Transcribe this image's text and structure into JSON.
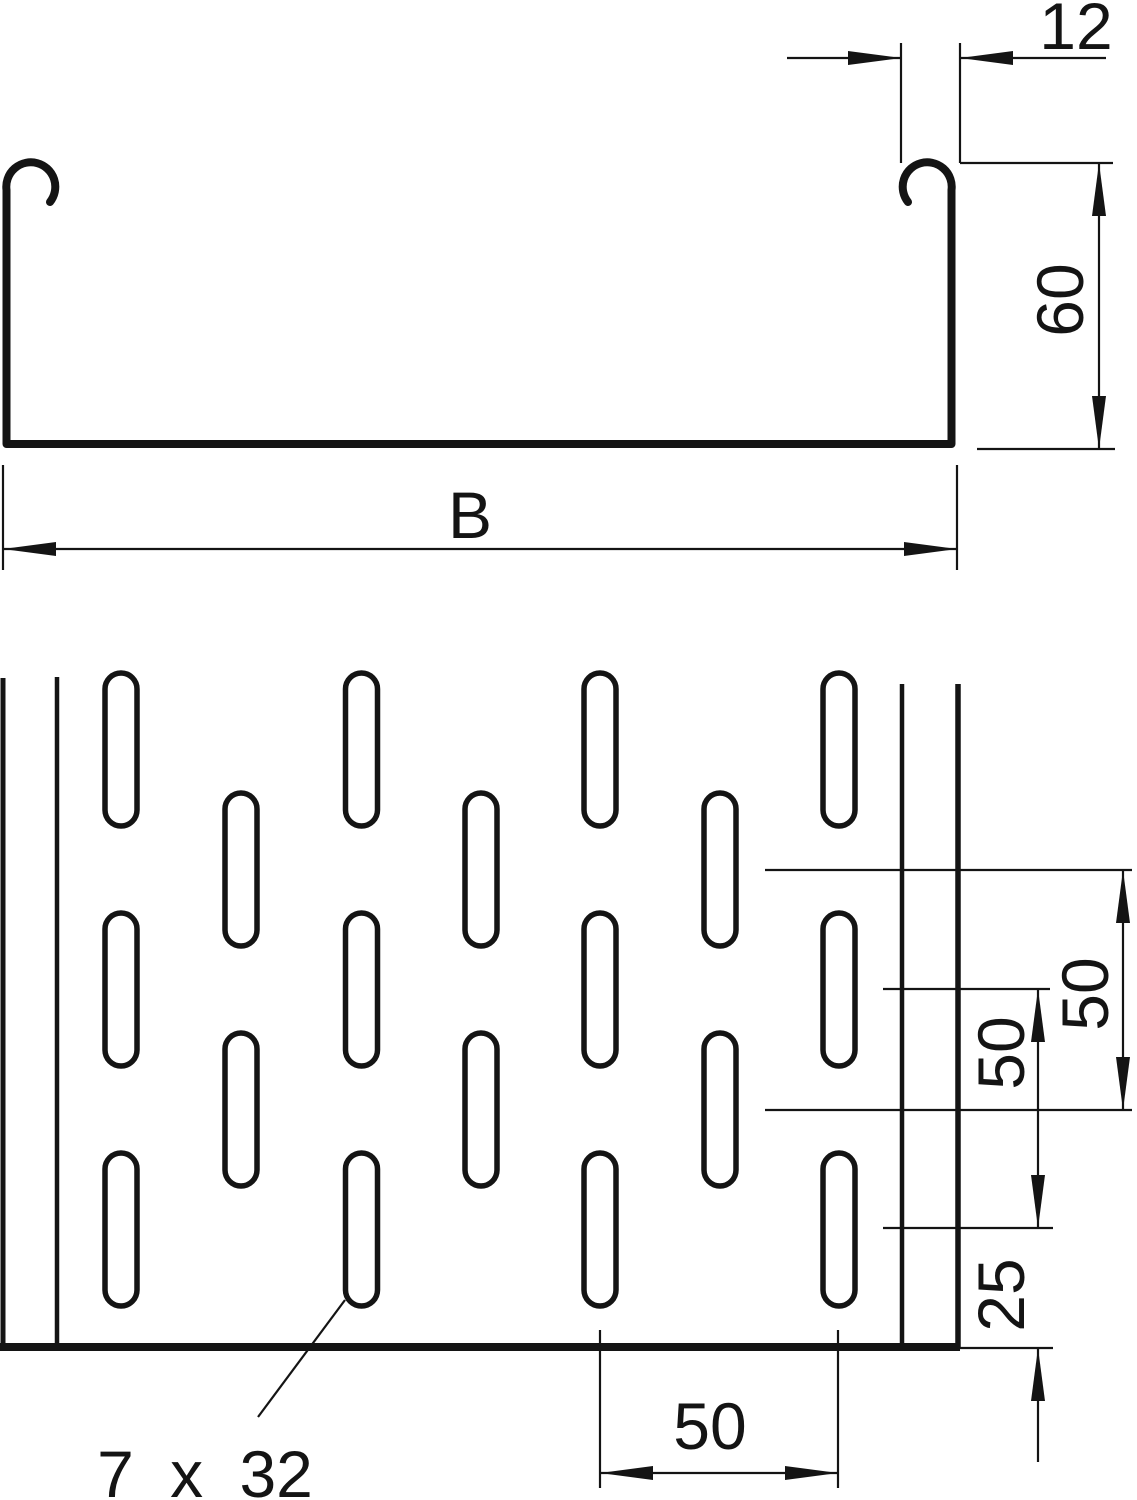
{
  "cross_section": {
    "top_flange_width": "12",
    "side_height": "60",
    "overall_width": "B"
  },
  "plan_view": {
    "pitch_outer": "50",
    "pitch_inner": "50",
    "end_offset": "25",
    "column_pitch": "50",
    "slot_size": "7 x 32"
  },
  "colors": {
    "line": "#141414",
    "background": "#ffffff"
  }
}
